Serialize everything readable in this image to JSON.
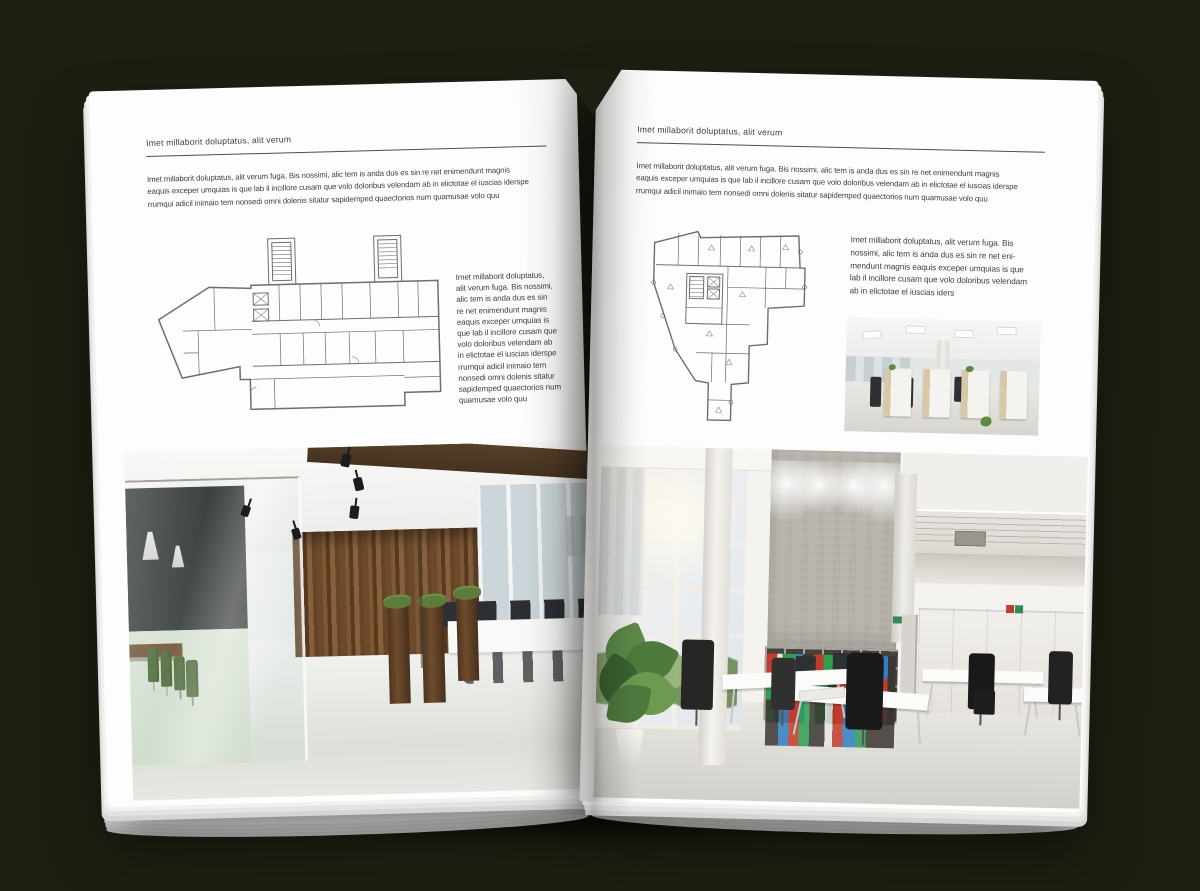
{
  "scene": {
    "background_color": "#1e1f12",
    "description": "Open magazine spread mockup lying on a dark surface"
  },
  "left_page": {
    "header": "Imet millaborit doluptatus, alit verum",
    "intro": "Imet millaborit doluptatus, alit verum fuga. Bis nossimi, alic tem is anda dus es sin re net enimendunt magnis\neaquis exceper umquias is que lab il incillore cusam que volo doloribus velendam ab in elictotae el iuscias iderspe\nrrumqui adicil inimaio tem nonsedi omni dolenis sitatur sapidemped quaectorios num quamusae volo quu",
    "side_text": "Imet millaborit doluptatus,\nalit verum fuga. Bis nossimi,\nalic tem is anda dus es sin\nre net enimendunt magnis\neaquis exceper umquias is\nque lab il incillore cusam que\nvolo doloribus velendam ab\nin elictotae el iuscias iderspe\nrrumqui adicil inimaio tem\nnonsedi omni dolenis sitatur\nsapidemped quaectorios num\nquamusae volo quu",
    "floor_plan": "Floor plan of a wide office building with twin stair towers",
    "photo": "Office interior with glass meeting room, green chairs and dark wooden feature wall"
  },
  "right_page": {
    "header": "Imet millaborit doluptatus, alit verum",
    "intro": "Imet millaborit doluptatus, alit verum fuga. Bis nossimi, alic tem is anda dus es sin re net enimendunt magnis\neaquis exceper umquias is que lab il incillore cusam que volo doloribus velendam ab in elictotae el iuscias iderspe\nrrumqui adicil inimaio tem nonsedi omni dolenis sitatur sapidemped quaectorios num quamusae volo quu",
    "side_text": "Imet millaborit doluptatus, alit verum fuga. Bis\nnossimi, alic tem is anda dus es sin re net eni-\nmendunt magnis eaquis exceper umquias is que\nlab il incillore cusam que volo doloribus velendam\nab in elictotae el iuscias iders",
    "floor_plan": "Floor plan of an irregular tower footprint with central core",
    "photo_small": "Open-plan office with pale wood cabinets and black task chairs",
    "photo_large": "Double-height white office with concrete wall, binder shelves and sunlit glazing"
  },
  "colors": {
    "page": "#fdfdfd",
    "body_text": "#3e3e3e",
    "rule": "#4d4d4d",
    "plan_line": "#6e6e6e",
    "wood": "#6e4a2b",
    "chair_green": "#47632f",
    "concrete": "#b9b5ad",
    "binder_red": "#c23b2e",
    "binder_green": "#2e9e4f",
    "binder_blue": "#2f7fc2"
  }
}
